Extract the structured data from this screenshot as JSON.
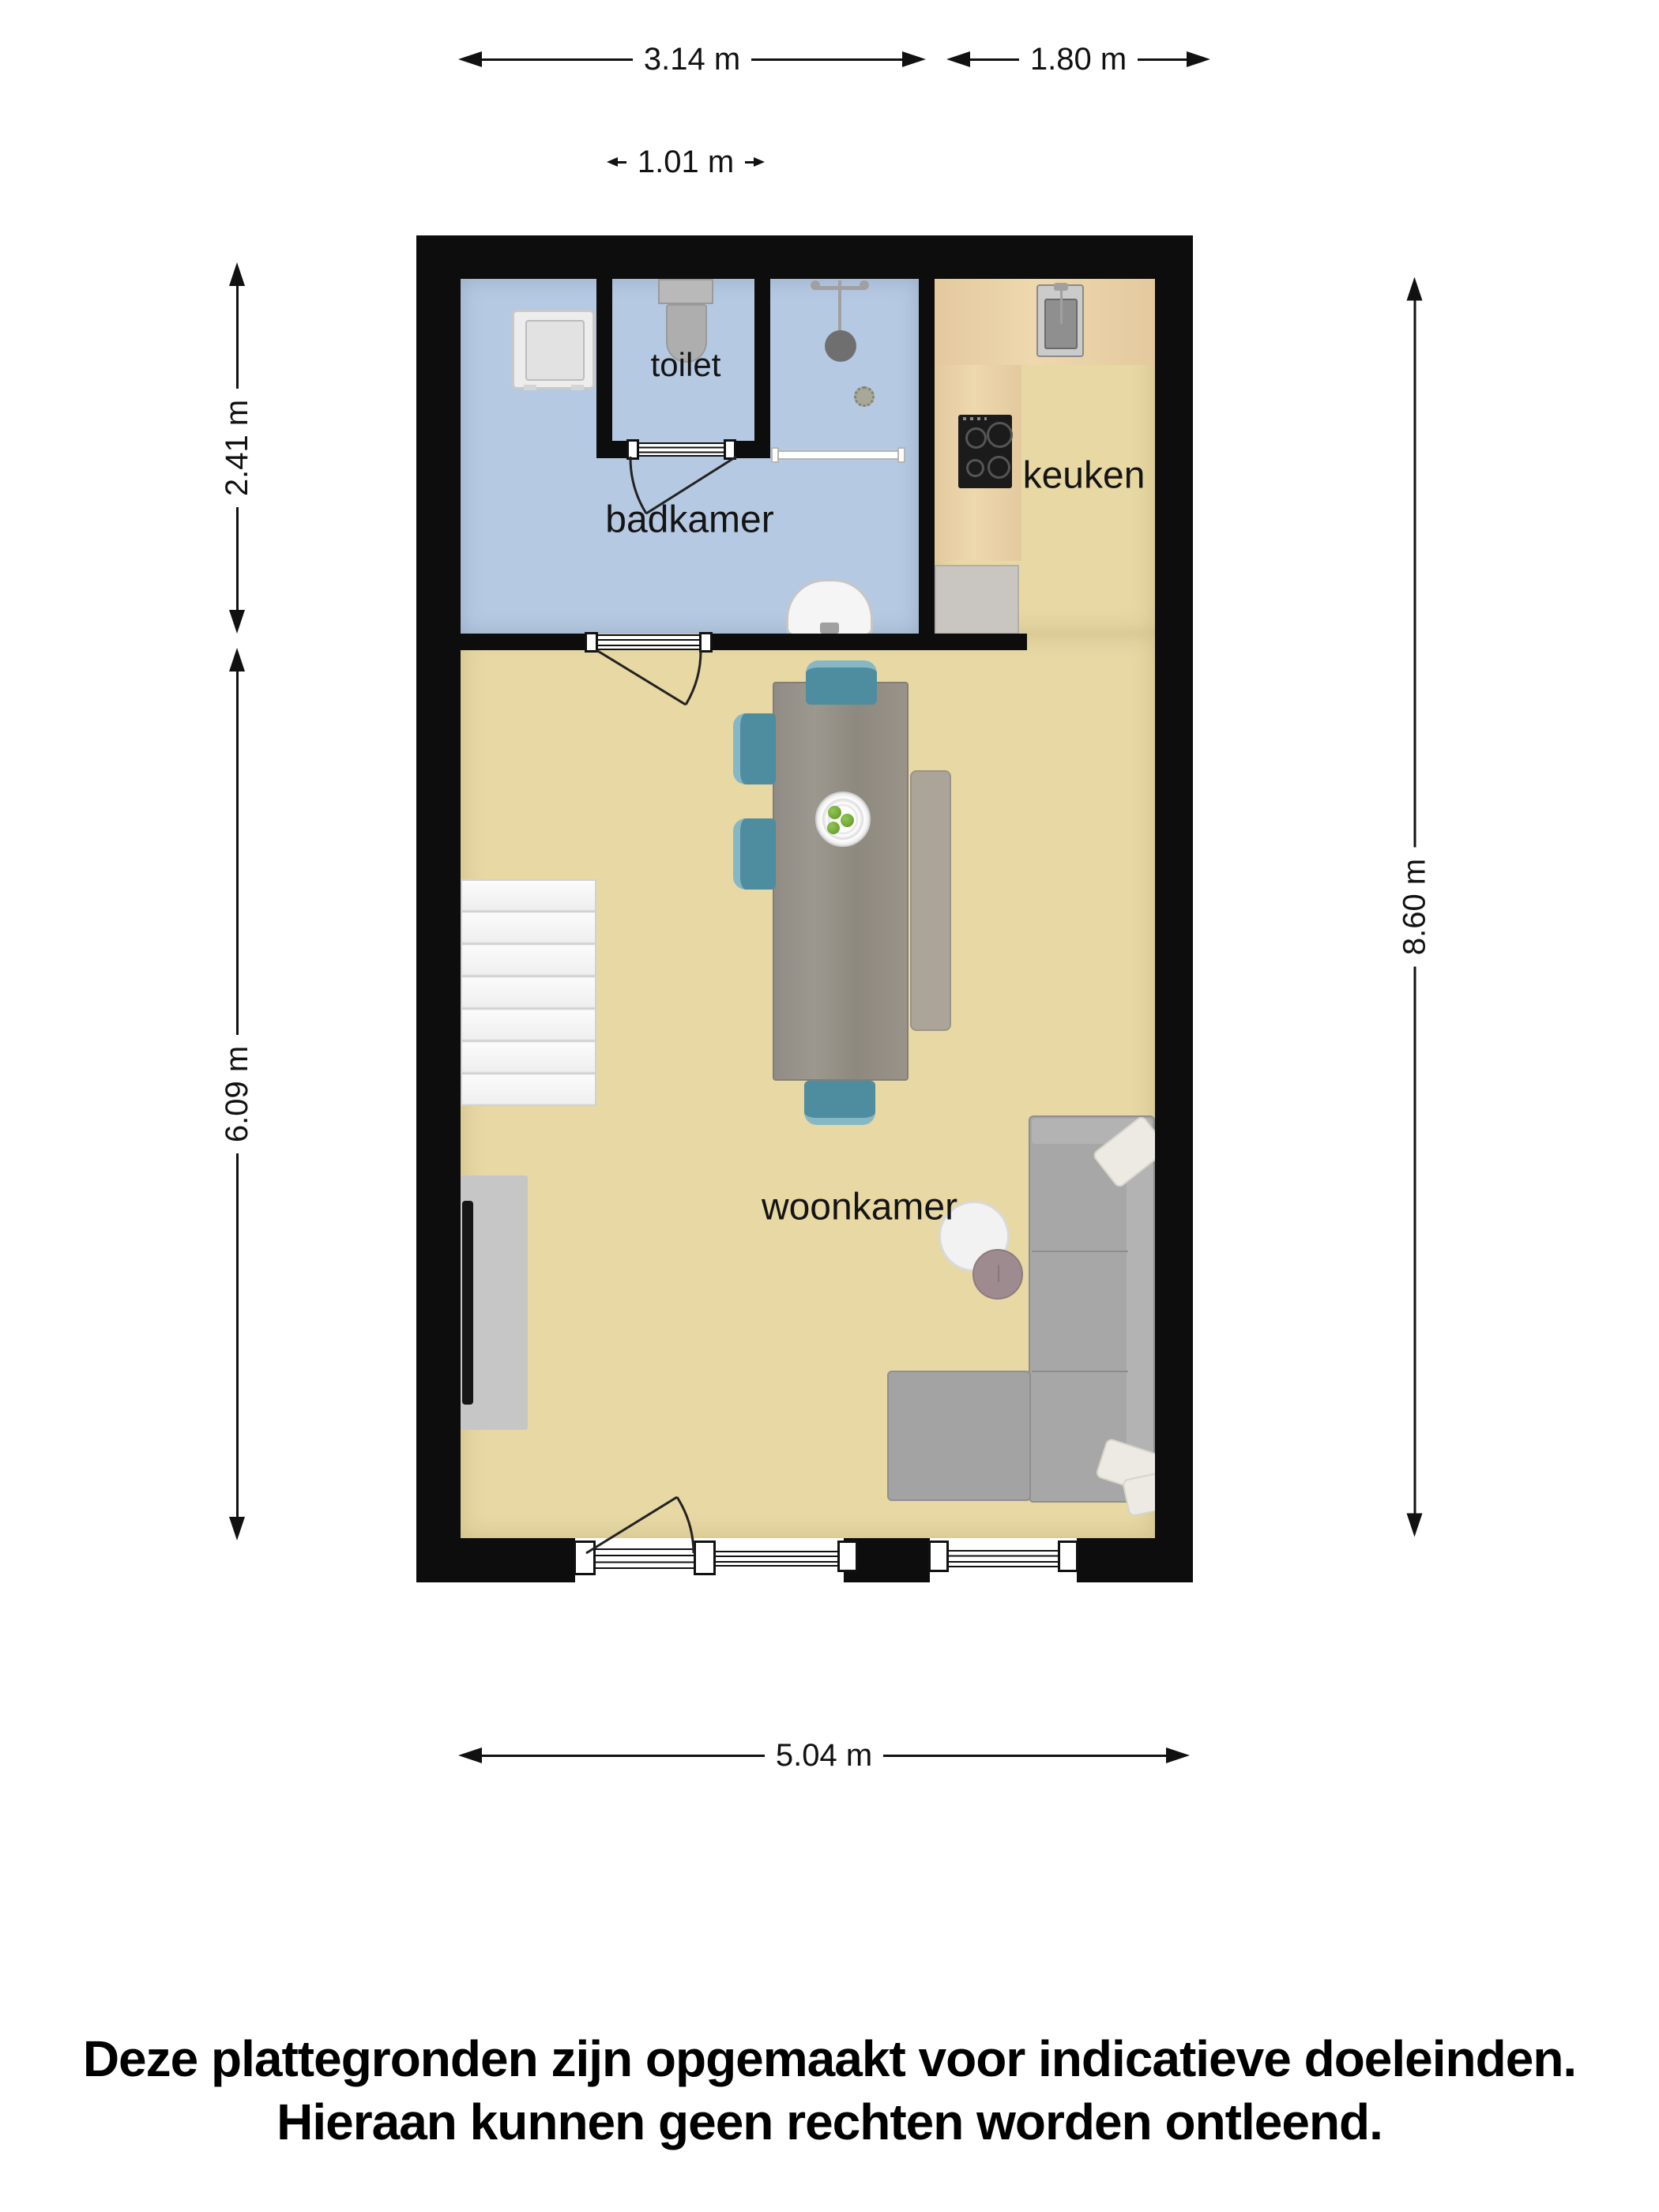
{
  "theme": {
    "wall": "#0d0d0d",
    "bath-floor": "#b6c9e2",
    "living-floor": "#e7d8a4",
    "counter": "#e4c99e",
    "appliance": "#c9c6c1",
    "chair": "#4e8ca0",
    "table": "#95908a",
    "bench": "#aba599",
    "sofa": "#a7a7a7",
    "pillow": "#eceae3",
    "tv-cabinet": "#c6c6c6",
    "side-table-white": "#f2f2f2",
    "side-table-mauve": "#9e8b90"
  },
  "dimensions": {
    "top_left": "3.14 m",
    "top_right": "1.80 m",
    "toilet_width": "1.01 m",
    "bathroom_height": "2.41 m",
    "living_height": "6.09 m",
    "total_height": "8.60 m",
    "bottom_width": "5.04 m"
  },
  "rooms": {
    "toilet": {
      "label": "toilet"
    },
    "bathroom": {
      "label": "badkamer"
    },
    "kitchen": {
      "label": "keuken"
    },
    "living": {
      "label": "woonkamer"
    }
  },
  "disclaimer": {
    "line1": "Deze plattegronden zijn opgemaakt voor indicatieve doeleinden.",
    "line2": "Hieraan kunnen geen rechten worden ontleend."
  }
}
